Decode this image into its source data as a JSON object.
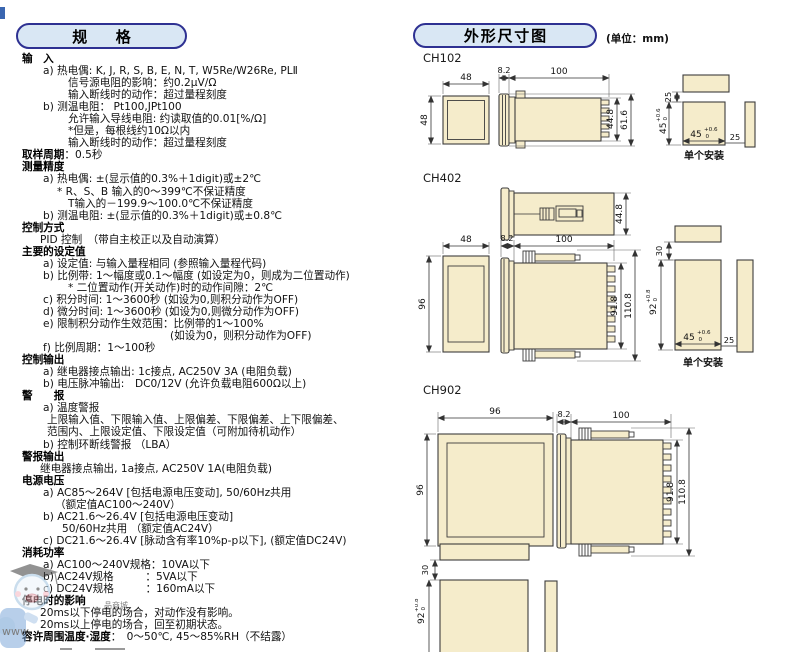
{
  "spec": {
    "title": "规格",
    "lines": [
      {
        "i": 0,
        "b": "输　入",
        "t": ""
      },
      {
        "i": 2,
        "t": "a) 热电偶: K, J, R, S, B, E, N, T, W5Re/W26Re, PLⅡ"
      },
      {
        "i": 7,
        "t": "信号源电阻的影响：约0.2μV/Ω"
      },
      {
        "i": 7,
        "t": "输入断线时的动作：超过量程刻度"
      },
      {
        "i": 2,
        "t": "b) 测温电阻： Pt100,JPt100"
      },
      {
        "i": 7,
        "t": "允许输入导线电阻: 约读取值的0.01[%/Ω]"
      },
      {
        "i": 7,
        "t": "*但是，每根线约10Ω以内"
      },
      {
        "i": 7,
        "t": "输入断线时的动作：超过量程刻度"
      },
      {
        "i": 0,
        "b": "取样周期",
        "t": "：0.5秒"
      },
      {
        "i": 0,
        "b": "测量精度",
        "t": ""
      },
      {
        "i": 2,
        "t": "a) 热电偶: ±(显示值的0.3%＋1digit)或±2℃"
      },
      {
        "i": 5,
        "t": "* R、S、B 输入的0～399℃不保证精度"
      },
      {
        "i": 7,
        "t": "T输入的－199.9～100.0℃不保证精度"
      },
      {
        "i": 2,
        "t": "b) 测温电阻: ±(显示值的0.3%＋1digit)或±0.8℃"
      },
      {
        "i": 0,
        "b": "控制方式",
        "t": ""
      },
      {
        "i": 1,
        "t": "PID 控制　（带自主校正以及自动演算）"
      },
      {
        "i": 0,
        "b": "主要的设定值",
        "t": ""
      },
      {
        "i": 2,
        "t": "a) 设定值: 与输入量程相同 (参照输入量程代码)"
      },
      {
        "i": 2,
        "t": "b) 比例带: 1～幅度或0.1～幅度 (如设定为0，则成为二位置动作)"
      },
      {
        "i": 7,
        "t": "* 二位置动作(开关动作)时的动作间隙：2℃"
      },
      {
        "i": 2,
        "t": "c) 积分时间: 1～3600秒 (如设为0,则积分动作为OFF)"
      },
      {
        "i": 2,
        "t": "d) 微分时间: 1～3600秒 (如设为0,则微分动作为OFF)"
      },
      {
        "i": 2,
        "t": "e) 限制积分动作生效范围：比例带的1～100%"
      },
      {
        "i": 8,
        "t": "(如设为0，则积分动作为OFF)"
      },
      {
        "i": 2,
        "t": "f) 比例周期：1～100秒"
      },
      {
        "i": 0,
        "b": "控制输出",
        "t": ""
      },
      {
        "i": 2,
        "t": "a) 继电器接点输出: 1c接点, AC250V 3A (电阻负载)"
      },
      {
        "i": 2,
        "t": "b) 电压脉冲输出:　DC0/12V (允许负载电阻600Ω以上)"
      },
      {
        "i": 0,
        "b": "警　　报",
        "t": ""
      },
      {
        "i": 2,
        "t": "a) 温度警报"
      },
      {
        "i": 3,
        "t": "上限输入值、下限输入值、上限偏差、下限偏差、上下限偏差、"
      },
      {
        "i": 3,
        "t": "范围内、上限设定值、下限设定值（可附加待机动作）"
      },
      {
        "i": 2,
        "t": "b) 控制环断线警报 （LBA）"
      },
      {
        "i": 0,
        "b": "警报输出",
        "t": ""
      },
      {
        "i": 1,
        "t": "继电器接点输出, 1a接点, AC250V 1A(电阻负载)"
      },
      {
        "i": 0,
        "b": "电源电压",
        "t": ""
      },
      {
        "i": 2,
        "t": "a) AC85～264V [包括电源电压变动], 50/60Hz共用"
      },
      {
        "i": 4,
        "t": "（额定值AC100～240V）"
      },
      {
        "i": 2,
        "t": "b) AC21.6～26.4V [包括电源电压变动]"
      },
      {
        "i": 6,
        "t": "50/60Hz共用 （额定值AC24V）"
      },
      {
        "i": 2,
        "t": "c) DC21.6～26.4V [脉动含有率10%p-p以下], (额定值DC24V)"
      },
      {
        "i": 0,
        "b": "消耗功率",
        "t": ""
      },
      {
        "i": 2,
        "t": "a) AC100～240V规格：10VA以下"
      },
      {
        "i": 2,
        "t": "b) AC24V规格　　　：5VA以下"
      },
      {
        "i": 2,
        "t": "c) DC24V规格　　　：160mA以下"
      },
      {
        "i": 0,
        "b": "停电时的影响",
        "t": ""
      },
      {
        "i": 1,
        "t": "20ms以下停电的场合，对动作没有影响。"
      },
      {
        "i": 1,
        "t": "20ms以上停电的场合，回至初期状态。"
      },
      {
        "i": 0,
        "b": "容许周围温度·湿度",
        "t": "：　0～50℃, 45～85%RH（不结露）"
      }
    ]
  },
  "dims_header": {
    "title": "外形尺寸图",
    "unit_note": "(单位：mm)"
  },
  "drawings": {
    "ch102": {
      "label": "CH102",
      "front_w": "48",
      "front_h": "48",
      "bezel_d": "8.2",
      "body_d": "100",
      "h_inner": "44.8",
      "h_outer": "61.6",
      "cut_gap_top": "25",
      "cut_h": "45",
      "cut_h_tp": "+0.6",
      "cut_h_tb": "0",
      "cut_w": "45",
      "cut_w_tp": "+0.6",
      "cut_w_tb": "0",
      "cut_gap_right": "25",
      "caption": "单个安装"
    },
    "ch402": {
      "label": "CH402",
      "top_w": "44.8",
      "front_w": "48",
      "front_h": "96",
      "bezel_d": "8.2",
      "body_d": "100",
      "h_inner": "91.8",
      "h_outer": "110.8",
      "cut_gap_top": "30",
      "cut_h": "92",
      "cut_h_tp": "+0.8",
      "cut_h_tb": "0",
      "cut_w": "45",
      "cut_w_tp": "+0.6",
      "cut_w_tb": "0",
      "cut_gap_right": "25",
      "caption": "单个安装"
    },
    "ch902": {
      "label": "CH902",
      "front_w": "96",
      "front_h": "96",
      "bezel_d": "8.2",
      "body_d": "100",
      "h_inner": "91.8",
      "h_outer": "110.8",
      "cut_gap_top": "30",
      "cut_h": "92",
      "cut_h_tp": "+0.8",
      "cut_h_tb": "0"
    }
  },
  "watermark": {
    "url": "www.",
    "store": "品商城"
  }
}
